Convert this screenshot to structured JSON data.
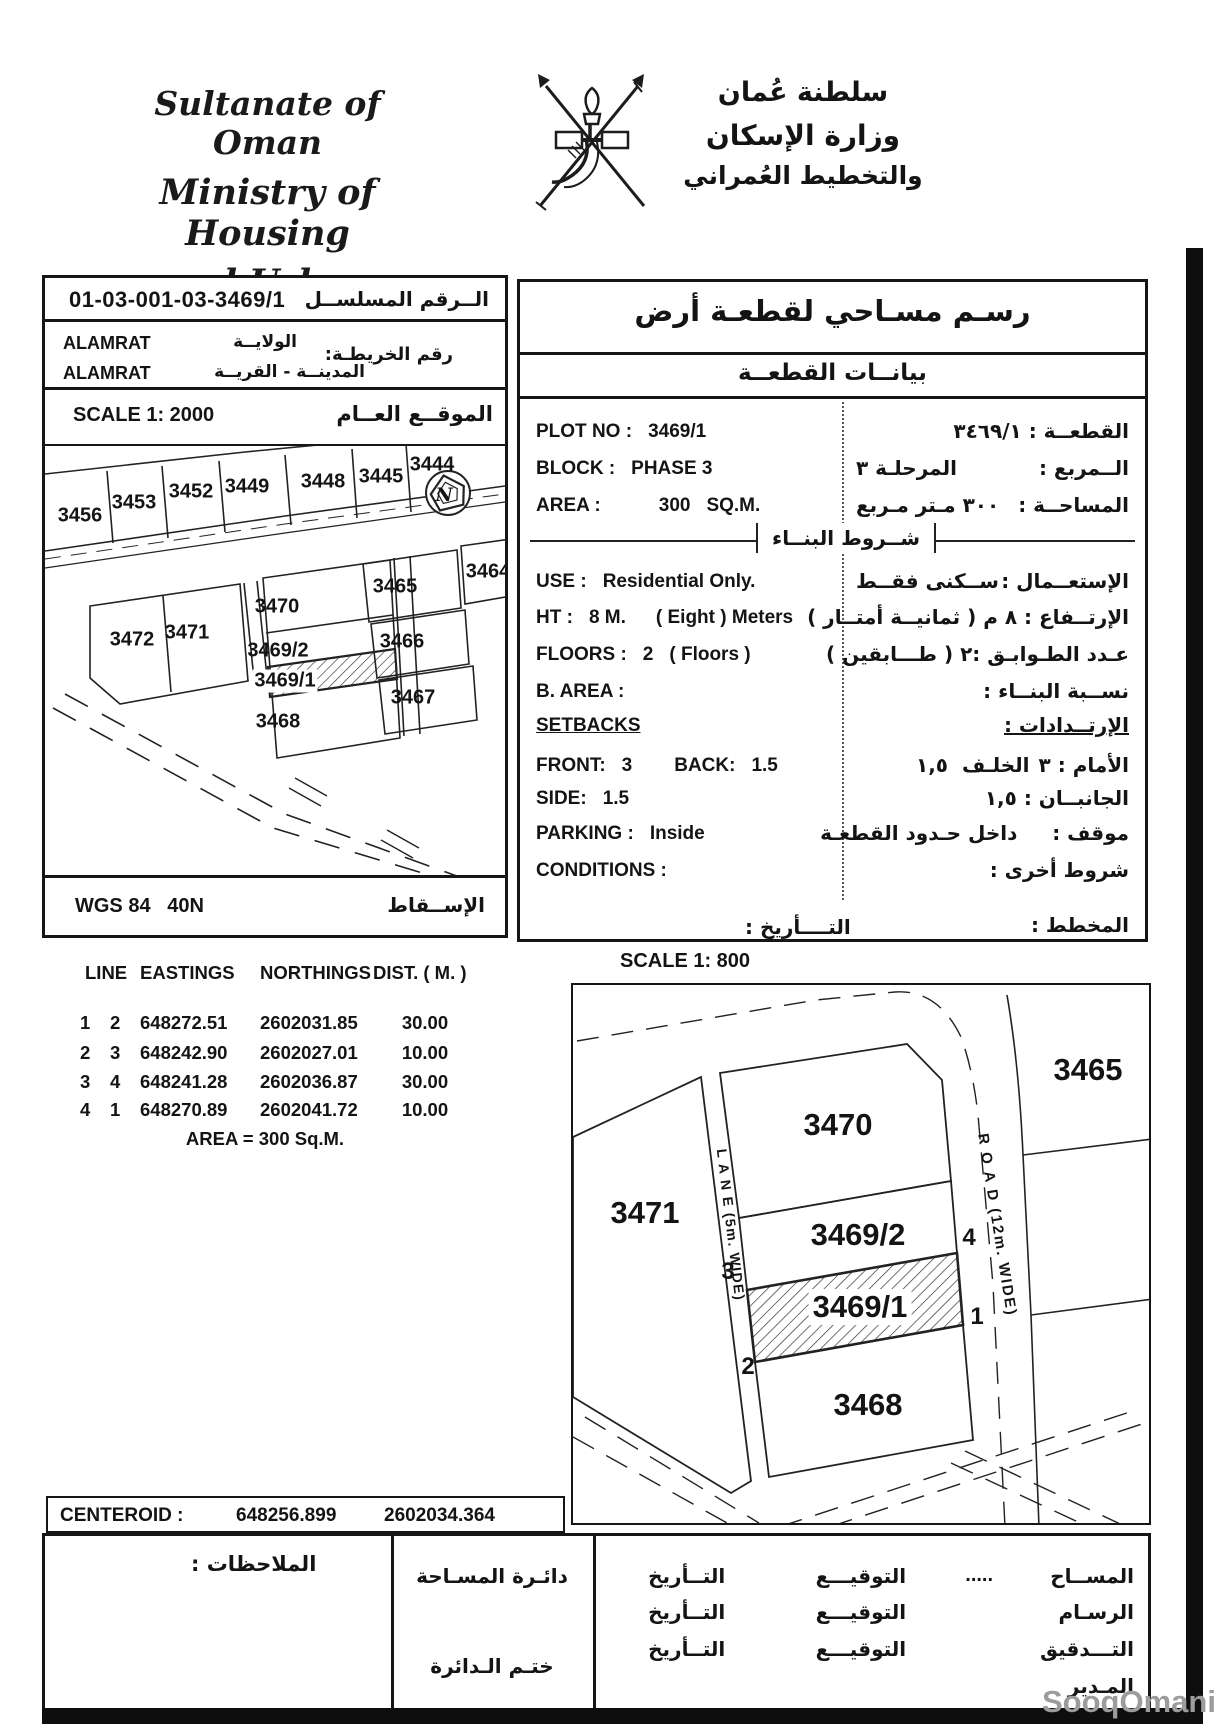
{
  "header": {
    "org_lines": [
      "Sultanate of Oman",
      "Ministry of Housing",
      "and Urban Planning"
    ],
    "org_lines_ar": [
      "سلطنة عُمان",
      "وزارة الإسكان",
      "والتخطيط العُمراني"
    ]
  },
  "serial_box": {
    "value": "01-03-001-03-3469/1",
    "label_ar": "الــرقم المسلســل"
  },
  "region_box": {
    "map_no_label_ar": "رقم الخريطـة:",
    "rows": [
      {
        "value": "ALAMRAT",
        "label_ar": "الولايــة"
      },
      {
        "value": "ALAMRAT",
        "label_ar": "المدينــة - القريــة"
      }
    ]
  },
  "location_map": {
    "scale_label": "SCALE 1: 2000",
    "title_ar": "الموقــع العــام",
    "north_label": "N",
    "plot_labels": [
      "3456",
      "3453",
      "3452",
      "3449",
      "3448",
      "3445",
      "3444",
      "3465",
      "3464",
      "3470",
      "3472",
      "3471",
      "3469/2",
      "3469/1",
      "3466",
      "3467",
      "3468"
    ]
  },
  "projection_box": {
    "value": "WGS 84   40N",
    "label_ar": "الإســقاط"
  },
  "panel": {
    "title_ar": "رسـم مسـاحي لقطعـة أرض",
    "subtitle_ar": "بيانــات القطعــة",
    "en": {
      "plot_no_label": "PLOT NO :",
      "plot_no": "3469/1",
      "block_label": "BLOCK :",
      "block": "PHASE 3",
      "area_label": "AREA :",
      "area": "300",
      "area_unit": "SQ.M.",
      "use_label": "USE :",
      "use": "Residential Only.",
      "ht_label": "HT :",
      "ht": "8 M.",
      "ht_note": "( Eight ) Meters",
      "floors_label": "FLOORS :",
      "floors": "2",
      "floors_note": "( Floors )",
      "b_area_label": "B. AREA :",
      "setbacks_label": "SETBACKS",
      "front_label": "FRONT:",
      "front": "3",
      "back_label": "BACK:",
      "back": "1.5",
      "side_label": "SIDE:",
      "side": "1.5",
      "parking_label": "PARKING :",
      "parking": "Inside",
      "conditions_label": "CONDITIONS :"
    },
    "ar": {
      "plot": "القطعــة : ٣٤٦٩/١",
      "block_label": "الــمربع :",
      "block_value": "المرحلـة ٣",
      "area_label": "المساحــة :",
      "area_value": "٣٠٠ مـتر مـربع",
      "building_conditions": "شــروط البنــاء",
      "use_label": "الإستعــمال :",
      "use_value": "ســكنى فقــط",
      "height": "الإرتــفاع : ٨ م ( ثمانيــة أمتــار )",
      "floors_label": "عـدد الطـوابـق :",
      "floors_value": "٢ ( طـــابقين )",
      "b_area": "نســبة البنــاء :",
      "setbacks": "الإرتــدادات :",
      "front_label": "الأمام : ٣",
      "back_value": "الخلـف  ١,٥",
      "side": "الجانبــان : ١,٥",
      "parking": "موقف :     داخل حـدود القطعـة",
      "conditions": "شروط أخرى :",
      "date_label": "التــــأريخ :",
      "plan_label": "المخطط :"
    }
  },
  "coords_table": {
    "headers": [
      "LINE",
      "EASTINGS",
      "NORTHINGS",
      "DIST. ( M. )"
    ],
    "rows": [
      {
        "from": "1",
        "to": "2",
        "easting": "648272.51",
        "northing": "2602031.85",
        "dist": "30.00"
      },
      {
        "from": "2",
        "to": "3",
        "easting": "648242.90",
        "northing": "2602027.01",
        "dist": "10.00"
      },
      {
        "from": "3",
        "to": "4",
        "easting": "648241.28",
        "northing": "2602036.87",
        "dist": "30.00"
      },
      {
        "from": "4",
        "to": "1",
        "easting": "648270.89",
        "northing": "2602041.72",
        "dist": "10.00"
      }
    ],
    "area_note": "AREA = 300 Sq.M."
  },
  "detail_map": {
    "scale_label": "SCALE 1: 800",
    "plot_labels": [
      "3465",
      "3470",
      "3471",
      "3469/2",
      "3469/1",
      "3468"
    ],
    "road_label": "R O A D (12m. WIDE)",
    "lane_label": "L A N E (5m. WIDE)",
    "corners": [
      "1",
      "2",
      "3",
      "4"
    ]
  },
  "centeroid": {
    "label": "CENTEROID :",
    "easting": "648256.899",
    "northing": "2602034.364"
  },
  "footer": {
    "notes_label_ar": "الملاحظات :",
    "dept_label_ar": "دائـرة المسـاحة",
    "stamp_label_ar": "ختـم الـدائرة",
    "rows": [
      {
        "role_ar": "المســاح",
        "dots": ".....",
        "sig_ar": "التوقيـــع",
        "date_ar": "التــأريخ"
      },
      {
        "role_ar": "الرسـام",
        "dots": "",
        "sig_ar": "التوقيـــع",
        "date_ar": "التــأريخ"
      },
      {
        "role_ar": "التـــدقيق",
        "dots": "",
        "sig_ar": "التوقيـــع",
        "date_ar": "التــأريخ"
      },
      {
        "role_ar": "المـدير",
        "dots": "",
        "sig_ar": "",
        "date_ar": ""
      }
    ]
  },
  "watermark": "SooqOmani"
}
